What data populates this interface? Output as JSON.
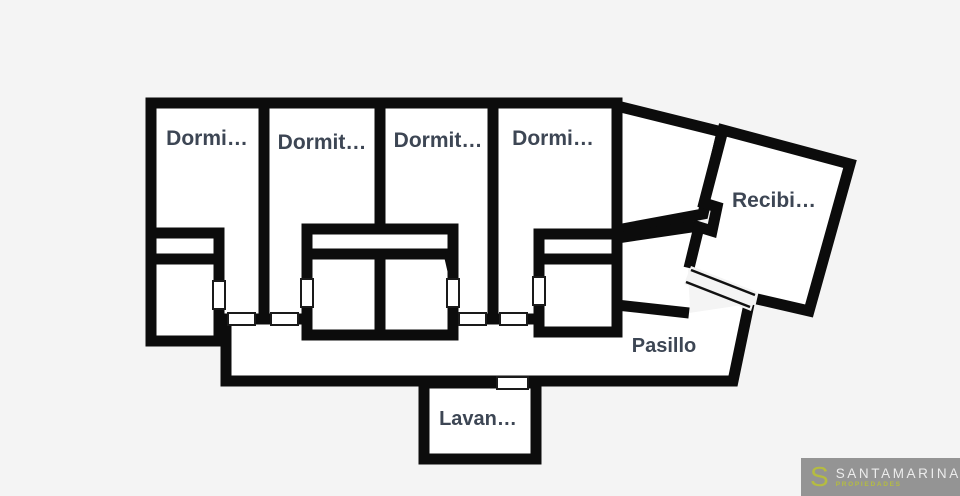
{
  "background_color": "#f4f4f4",
  "plan": {
    "wall_color": "#0c0c0c",
    "room_fill": "#ffffff",
    "label_color": "#3d4654",
    "rooms": {
      "bedroom1": "Dormi…",
      "bedroom2": "Dormit…",
      "bedroom3": "Dormit…",
      "bedroom4": "Dormi…",
      "reception": "Recibi…",
      "hallway": "Pasillo",
      "laundry": "Lavan…"
    }
  },
  "watermark": {
    "brand_initial": "S",
    "brand_name": "SANTAMARINA",
    "brand_subtitle": "PROPIEDADES",
    "bg_color": "#949494",
    "accent_color": "#b5bc41",
    "text_color": "#ececec"
  }
}
